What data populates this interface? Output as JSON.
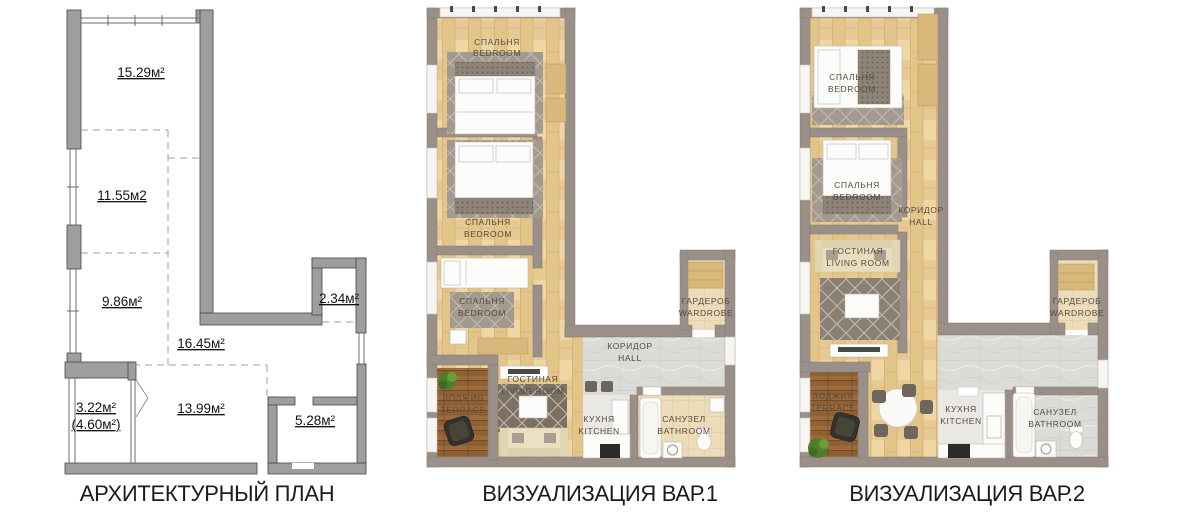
{
  "image": {
    "background": "#ffffff",
    "description": "apartment floor plan: architectural plan and two furnished visualizations"
  },
  "palette": {
    "plan_wall": "#9e9e9e",
    "viz_wall": "#9a9089",
    "wood_floor": "#e9cf9b",
    "tile_floor": "#dbdbd7",
    "beige_floor": "#ecdcba",
    "terrace_wood": "#905f33",
    "rug_gray": "#a29a8e",
    "room_label_text": "#564c40",
    "caption_text": "#1b1b1b"
  },
  "panels": {
    "architectural": {
      "caption": "АРХИТЕКТУРНЫЙ ПЛАН",
      "areas": {
        "top_room": "15.29м²",
        "middle_room": "11.55м2",
        "lower_room": "9.86м²",
        "hall": "16.45м²",
        "niche": "2.34м²",
        "terrace": "3.22м²",
        "terrace_alt": "(4.60м²)",
        "living": "13.99м²",
        "bathroom": "5.28м²"
      }
    },
    "viz1": {
      "caption": "ВИЗУАЛИЗАЦИЯ ВАР.1",
      "rooms": {
        "bedroom1": {
          "ru": "СПАЛЬНЯ",
          "en": "BEDROOM"
        },
        "bedroom2": {
          "ru": "СПАЛЬНЯ",
          "en": "BEDROOM"
        },
        "bedroom3": {
          "ru": "СПАЛЬНЯ",
          "en": "BEDROOM"
        },
        "living": {
          "ru": "ГОСТИНАЯ",
          "en": "LIVING ROOM"
        },
        "loggia": {
          "ru": "ЛОДЖИЯ",
          "en": "TERRACE"
        },
        "kitchen": {
          "ru": "КУХНЯ",
          "en": "KITCHEN"
        },
        "hall": {
          "ru": "КОРИДОР",
          "en": "HALL"
        },
        "bathroom": {
          "ru": "САНУЗЕЛ",
          "en": "BATHROOM"
        },
        "wardrobe": {
          "ru": "ГАРДЕРОБ",
          "en": "WARDROBE"
        }
      }
    },
    "viz2": {
      "caption": "ВИЗУАЛИЗАЦИЯ ВАР.2",
      "rooms": {
        "bedroom1": {
          "ru": "СПАЛЬНЯ",
          "en": "BEDROOM"
        },
        "bedroom2": {
          "ru": "СПАЛЬНЯ",
          "en": "BEDROOM"
        },
        "hall": {
          "ru": "КОРИДОР",
          "en": "HALL"
        },
        "living": {
          "ru": "ГОСТИНАЯ",
          "en": "LIVING ROOM"
        },
        "loggia": {
          "ru": "ЛОДЖИЯ",
          "en": "TERRACE"
        },
        "kitchen": {
          "ru": "КУХНЯ",
          "en": "KITCHEN"
        },
        "bathroom": {
          "ru": "САНУЗЕЛ",
          "en": "BATHROOM"
        },
        "wardrobe": {
          "ru": "ГАРДЕРОБ",
          "en": "WARDROBE"
        }
      }
    }
  }
}
